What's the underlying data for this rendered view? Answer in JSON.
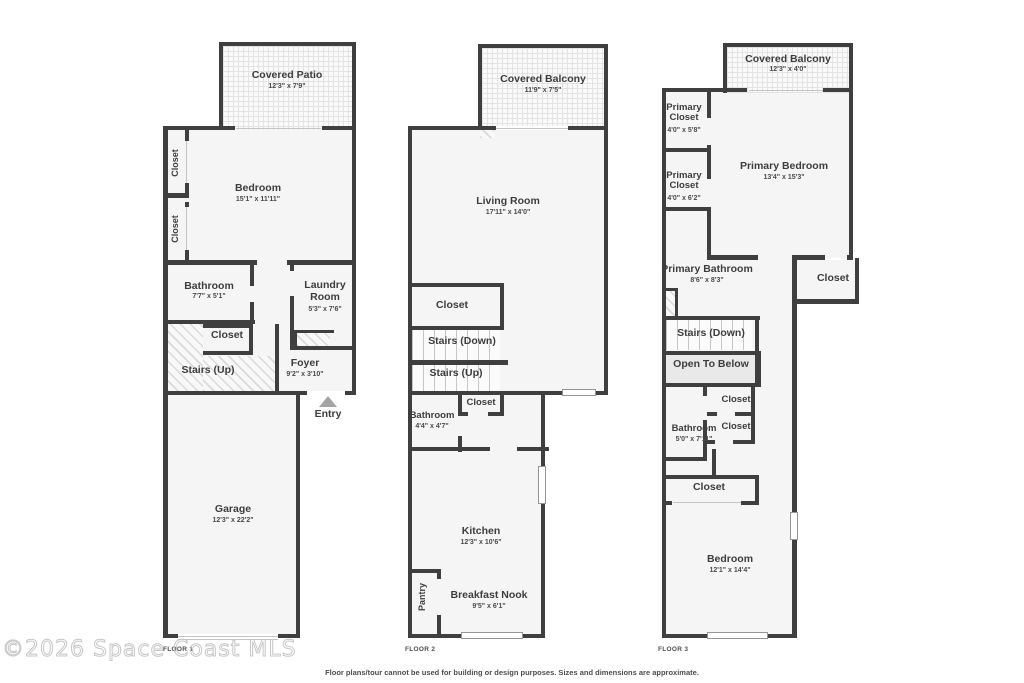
{
  "floors": [
    {
      "floor_label": "FLOOR 1",
      "entry_label": "Entry",
      "rooms": {
        "patio": {
          "name": "Covered Patio",
          "dims": "12'3\" x 7'9\""
        },
        "bedroom": {
          "name": "Bedroom",
          "dims": "15'1\" x 11'11\""
        },
        "closet_top": {
          "name": "Closet"
        },
        "closet_bottom": {
          "name": "Closet"
        },
        "bathroom": {
          "name": "Bathroom",
          "dims": "7'7\" x 5'1\""
        },
        "laundry": {
          "name": "Laundry Room",
          "dims": "5'3\" x 7'6\""
        },
        "closet_mid": {
          "name": "Closet"
        },
        "stairs_up": {
          "name": "Stairs (Up)"
        },
        "foyer": {
          "name": "Foyer",
          "dims": "9'2\" x 3'10\""
        },
        "garage": {
          "name": "Garage",
          "dims": "12'3\" x 22'2\""
        }
      }
    },
    {
      "floor_label": "FLOOR 2",
      "rooms": {
        "balcony": {
          "name": "Covered Balcony",
          "dims": "11'9\" x 7'5\""
        },
        "living": {
          "name": "Living Room",
          "dims": "17'11\" x 14'0\""
        },
        "closet": {
          "name": "Closet"
        },
        "stairs_down": {
          "name": "Stairs (Down)"
        },
        "stairs_up": {
          "name": "Stairs (Up)"
        },
        "closet_small": {
          "name": "Closet"
        },
        "bathroom": {
          "name": "Bathroom",
          "dims": "4'4\" x 4'7\""
        },
        "kitchen": {
          "name": "Kitchen",
          "dims": "12'3\" x 10'6\""
        },
        "pantry": {
          "name": "Pantry"
        },
        "nook": {
          "name": "Breakfast Nook",
          "dims": "9'5\" x 6'1\""
        }
      }
    },
    {
      "floor_label": "FLOOR 3",
      "rooms": {
        "balcony": {
          "name": "Covered Balcony",
          "dims": "12'3\" x 4'0\""
        },
        "pcloset1": {
          "name": "Primary Closet",
          "dims": "4'0\" x 5'8\""
        },
        "pcloset2": {
          "name": "Primary Closet",
          "dims": "4'0\" x 6'2\""
        },
        "pbedroom": {
          "name": "Primary Bedroom",
          "dims": "13'4\" x 15'3\""
        },
        "pbathroom": {
          "name": "Primary Bathroom",
          "dims": "8'6\" x 8'3\""
        },
        "closet_right": {
          "name": "Closet"
        },
        "stairs_down": {
          "name": "Stairs (Down)"
        },
        "open_below": {
          "name": "Open To Below"
        },
        "closet_a": {
          "name": "Closet"
        },
        "closet_b": {
          "name": "Closet"
        },
        "bathroom": {
          "name": "Bathroom",
          "dims": "5'0\" x 7'11\""
        },
        "closet_wide": {
          "name": "Closet"
        },
        "bedroom": {
          "name": "Bedroom",
          "dims": "12'1\" x 14'4\""
        }
      }
    }
  ],
  "footer": {
    "disclaimer": "Floor plans/tour cannot be used for building or design purposes. Sizes and dimensions are approximate."
  },
  "watermark": "©2026 Space Coast MLS"
}
